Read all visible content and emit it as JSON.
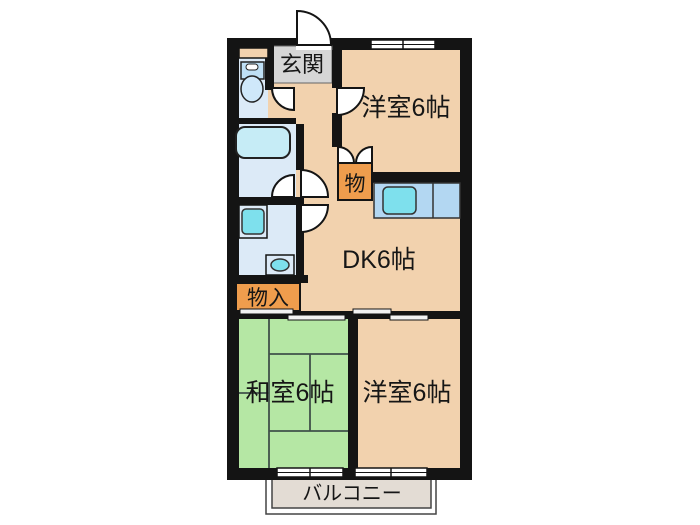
{
  "plan": {
    "type": "apartment-floorplan",
    "labels": {
      "genkan": "玄関",
      "western_room_top": "洋室6帖",
      "closet_top": "物",
      "dining_kitchen": "DK6帖",
      "storage": "物入",
      "japanese_room": "和室6帖",
      "western_room_bottom": "洋室6帖",
      "balcony": "バルコニー"
    },
    "fixtures": [
      "toilet-icon",
      "bathtub-icon",
      "washing-machine-icon",
      "washbasin-icon",
      "kitchen-sink-icon"
    ],
    "colors": {
      "wall": "#141414",
      "floor_peach": "#f2d2ae",
      "tatami_green": "#b5e7a4",
      "tatami_line": "#40514a",
      "wet_area_blue": "#dceaf7",
      "fixture_cyan": "#7ee0ed",
      "tub_cyan": "#c6ecf6",
      "counter_blue": "#b3d7f2",
      "closet_orange": "#ef9d4d",
      "genkan_gray": "#d6d6d6",
      "balcony_beige": "#e3dcd4",
      "door_white": "#ffffff"
    }
  }
}
